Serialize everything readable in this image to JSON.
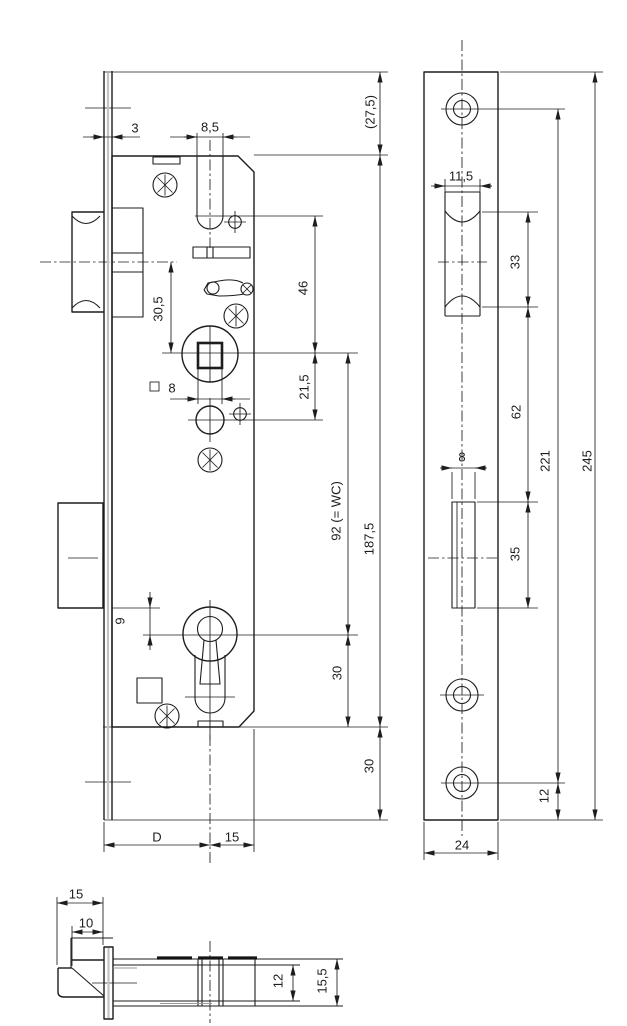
{
  "canvas": {
    "width": 627,
    "height": 1026,
    "background": "#ffffff",
    "line_color": "#1d1d1b"
  },
  "drawing_type": "mortise-lock dimensional drawing, three views",
  "icons": {
    "phillips_screw": "circle-with-star-spokes",
    "small_screw_hole": "circle-with-crosshair",
    "countersunk_screw_hole": "double-concentric-circle"
  },
  "dims": {
    "main": {
      "faceplate_thickness": "3",
      "follower_slot_width": "8,5",
      "top_margin": "(27,5)",
      "latch_to_spindle": "30,5",
      "slot_to_spindle": "46",
      "spindle_square": "8",
      "spindle_to_cylinder": "21,5",
      "spindle_to_keyhole": "92  (= WC)",
      "case_height": "187,5",
      "deadbolt_to_keyhole": "9",
      "keyhole_to_case_bottom": "30",
      "case_bottom_to_plate_end": "30",
      "backset": "D",
      "spindle_to_back_edge": "15"
    },
    "faceplate": {
      "latch_cutout_width": "11,5",
      "latch_cutout_height": "33",
      "cutout_spacing": "62",
      "bolt_cutout_width": "8",
      "bolt_cutout_height": "35",
      "screw_hole_spacing": "221",
      "plate_length": "245",
      "screw_to_plate_end": "12",
      "plate_width": "24"
    },
    "section": {
      "latch_projection": "15",
      "latch_bevel": "10",
      "case_inner_depth": "12",
      "case_depth": "15,5"
    }
  }
}
